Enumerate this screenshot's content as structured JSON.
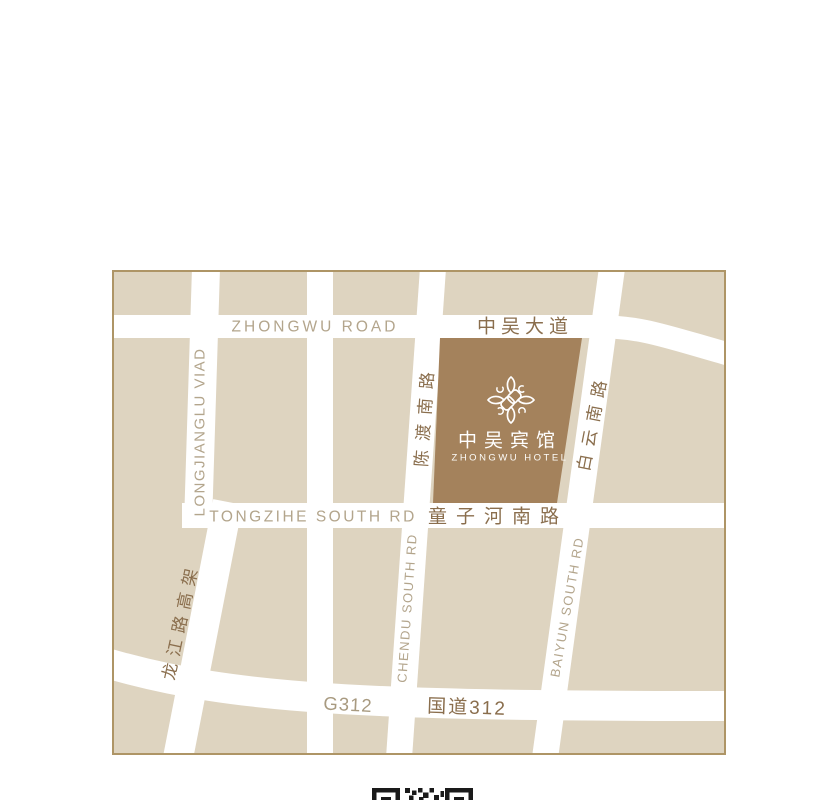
{
  "map": {
    "colors": {
      "land": "#ded4c0",
      "road": "#ffffff",
      "frame_border": "#ae9566",
      "hotel_block": "#a4825c",
      "label_en": "#b3a58c",
      "label_cn": "#8a6e4d",
      "hotel_text": "#ffffff",
      "qr": "#1a1a1a"
    },
    "labels": {
      "zhongwu_road_en": "ZHONGWU ROAD",
      "zhongwu_avenue_cn": "中吴大道",
      "longjianglu_viaduct_en": "LONGJIANGLU VIAD",
      "longjiang_viaduct_cn": "龙江路高架",
      "chendu_south_cn": "陈渡南路",
      "chendu_south_en": "CHENDU SOUTH RD",
      "baiyun_south_cn": "白云南路",
      "baiyun_south_en": "BAIYUN SOUTH RD",
      "tongzihe_south_en": "TONGZIHE SOUTH RD",
      "tongzihe_south_cn": "童子河南路",
      "g312_en": "G312",
      "g312_cn": "国道312"
    },
    "hotel": {
      "name_cn": "中吴宾馆",
      "name_en": "ZHONGWU HOTEL"
    }
  }
}
